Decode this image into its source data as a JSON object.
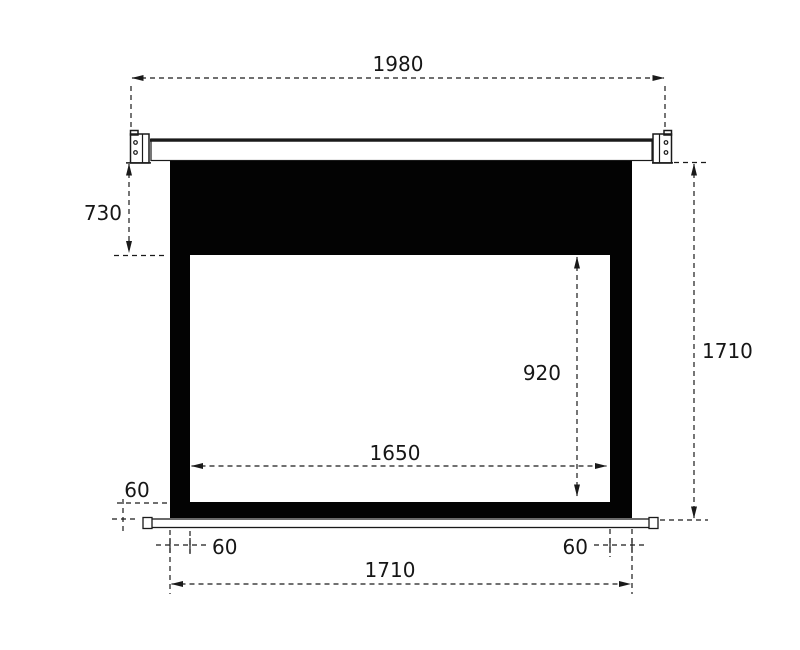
{
  "diagram": {
    "type": "projection-screen-dimension-drawing",
    "dims": {
      "case_width": "1980",
      "top_drop": "730",
      "total_height": "1710",
      "viewing_height": "920",
      "viewing_width": "1650",
      "bottom_border_height": "60",
      "left_border_width": "60",
      "right_border_width": "60",
      "fabric_width": "1710"
    },
    "colors": {
      "line": "#1a1a1a",
      "fabric": "#030303",
      "viewing_area": "#ffffff",
      "background": "#ffffff"
    }
  }
}
